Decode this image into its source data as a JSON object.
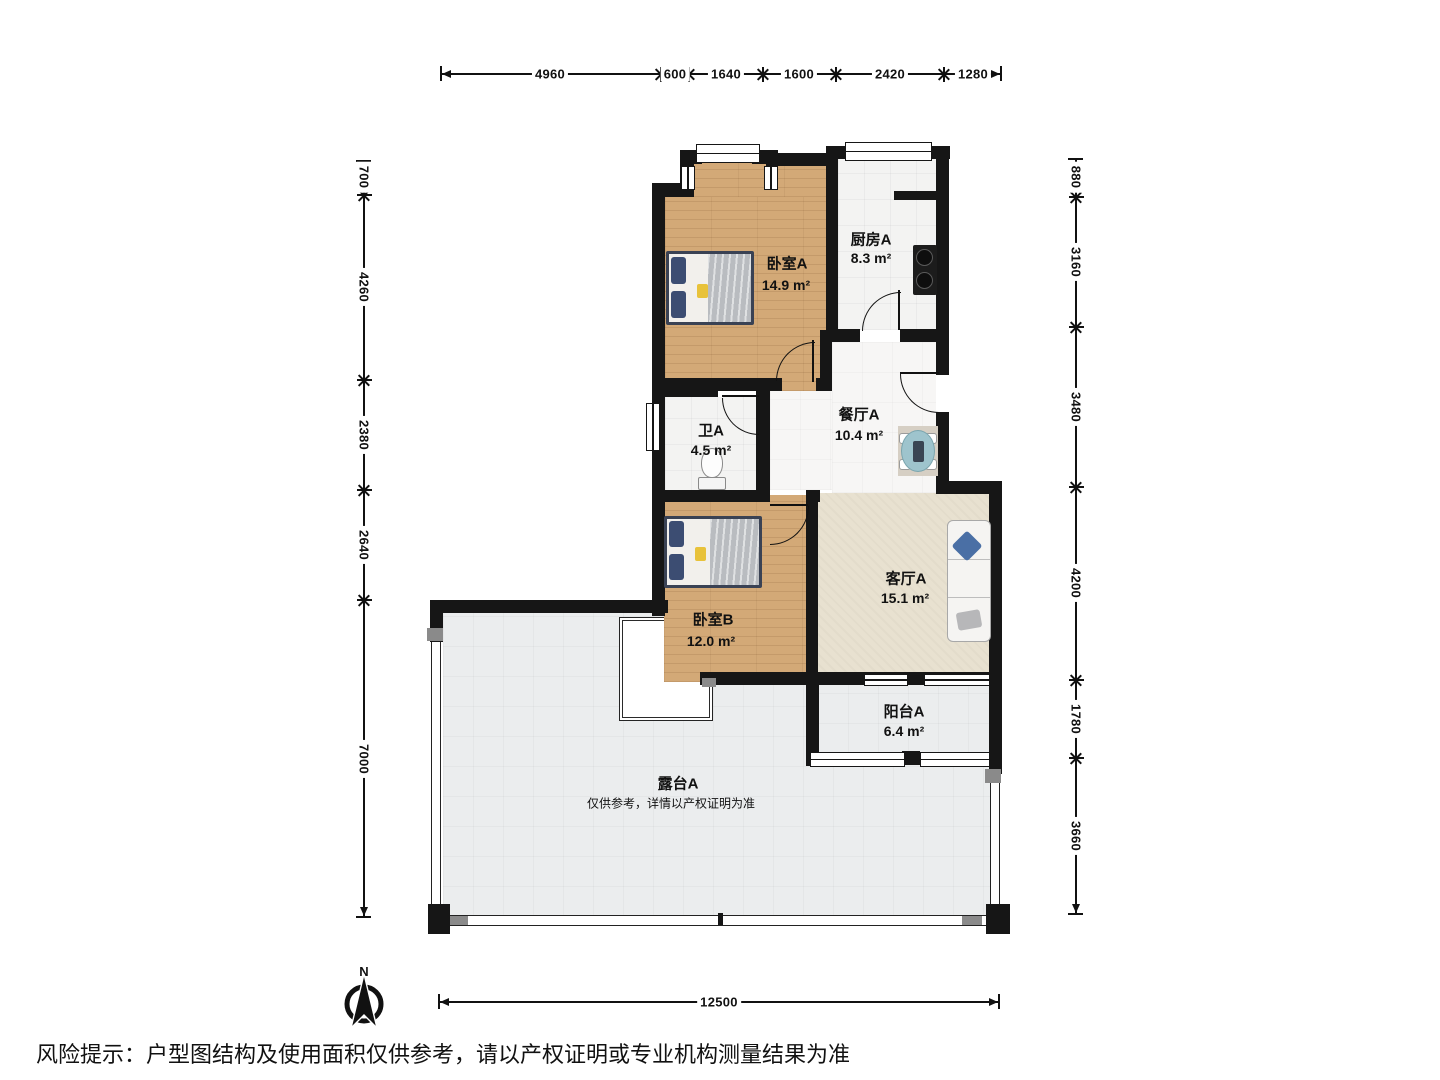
{
  "title_block": {
    "disclaimer": "风险提示：户型图结构及使用面积仅供参考，请以产权证明或专业机构测量结果为准"
  },
  "compass": {
    "north_label": "N"
  },
  "rooms": {
    "bedroom_a": {
      "name": "卧室A",
      "area": "14.9 m²"
    },
    "kitchen_a": {
      "name": "厨房A",
      "area": "8.3 m²"
    },
    "bath_a": {
      "name": "卫A",
      "area": "4.5 m²"
    },
    "dining_a": {
      "name": "餐厅A",
      "area": "10.4 m²"
    },
    "bedroom_b": {
      "name": "卧室B",
      "area": "12.0 m²"
    },
    "living_a": {
      "name": "客厅A",
      "area": "15.1 m²"
    },
    "balcony_a": {
      "name": "阳台A",
      "area": "6.4 m²"
    },
    "terrace_a": {
      "name": "露台A",
      "note": "仅供参考，详情以产权证明为准"
    }
  },
  "dimensions_mm": {
    "top": [
      "4960",
      "600",
      "1640",
      "1600",
      "2420",
      "1280"
    ],
    "left": [
      "700",
      "4260",
      "2380",
      "2640",
      "7000"
    ],
    "right": [
      "880",
      "3160",
      "3480",
      "4200",
      "1780",
      "3660"
    ],
    "bottom": [
      "12500"
    ]
  },
  "colors": {
    "wall": "#161616",
    "wood_floor": "#d3a977",
    "living_carpet": "#e8e1d0",
    "terrace_tile": "#ebedee",
    "table_teal": "#9ec4cd",
    "pillow_navy": "#3c4d72",
    "marker_yellow": "#e8c23a"
  }
}
